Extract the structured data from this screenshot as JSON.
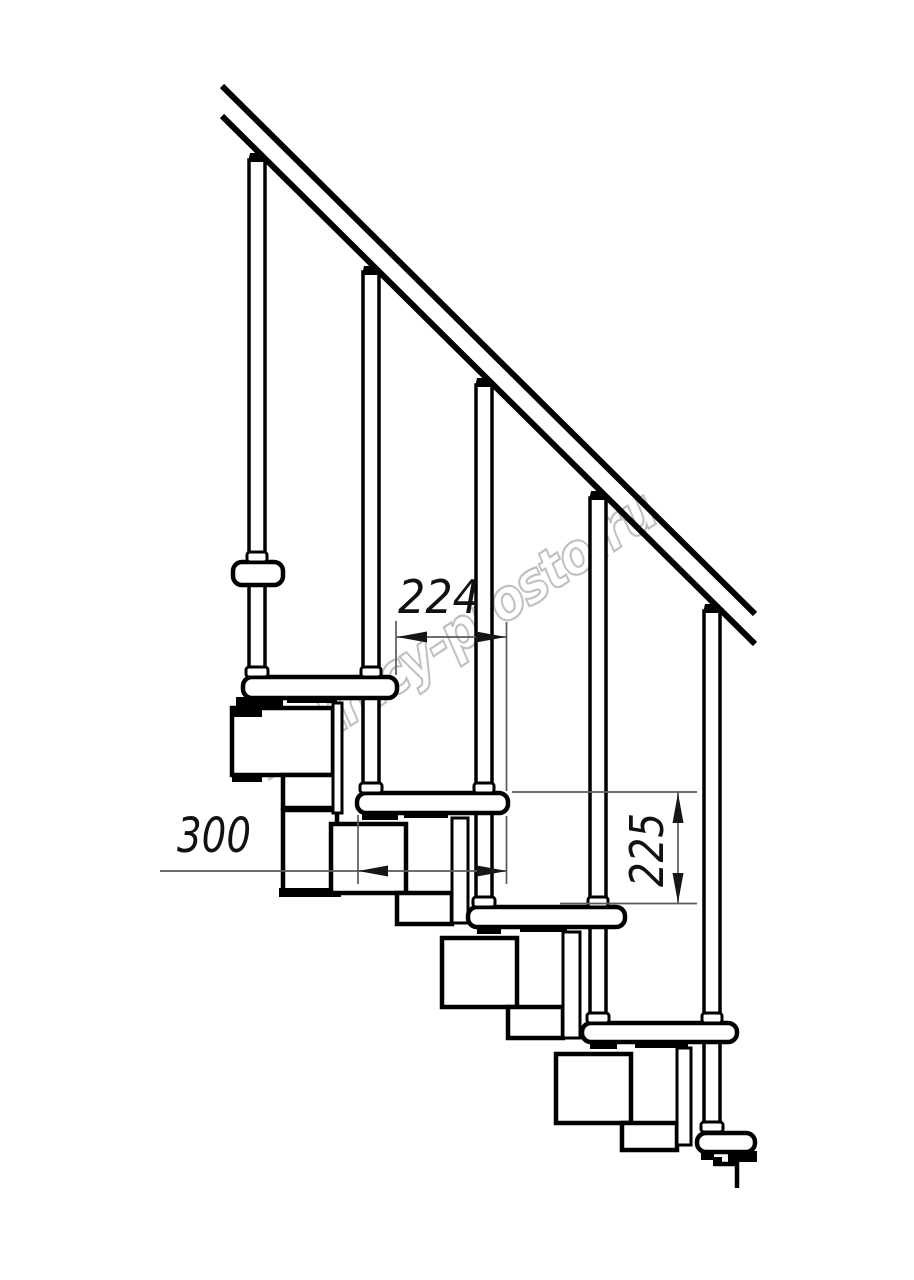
{
  "title": "Modular staircase fragment — side elevation technical drawing",
  "background": "#ffffff",
  "line_color": "#000000",
  "dim_color": "#5a5a5a",
  "watermark": {
    "text": "lestnicy-prosto.ru",
    "color": "#c0c0c0"
  },
  "dimensions": {
    "step_offset": {
      "label": "224",
      "orientation": "horizontal"
    },
    "tread_length": {
      "label": "300",
      "orientation": "horizontal"
    },
    "riser_height": {
      "label": "225",
      "orientation": "vertical"
    }
  },
  "components": {
    "handrail": "inclined handrail (two parallel rails)",
    "baluster_count": 5,
    "tread_count": 6,
    "spine": "chain of stacked support modules under treads"
  }
}
